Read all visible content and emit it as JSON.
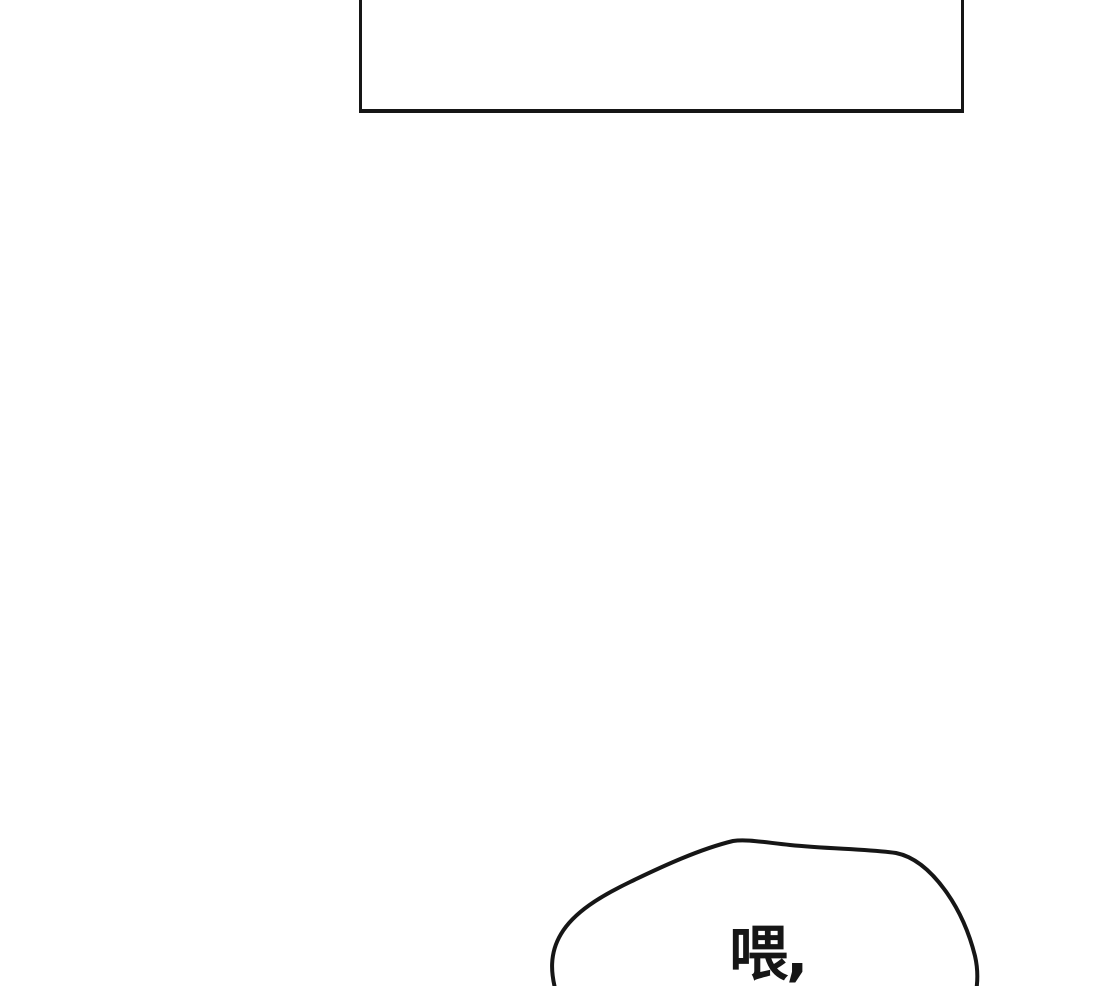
{
  "page": {
    "background_color": "#ffffff",
    "ink_color": "#161616"
  },
  "speech_bubble": {
    "text": "喂,"
  }
}
